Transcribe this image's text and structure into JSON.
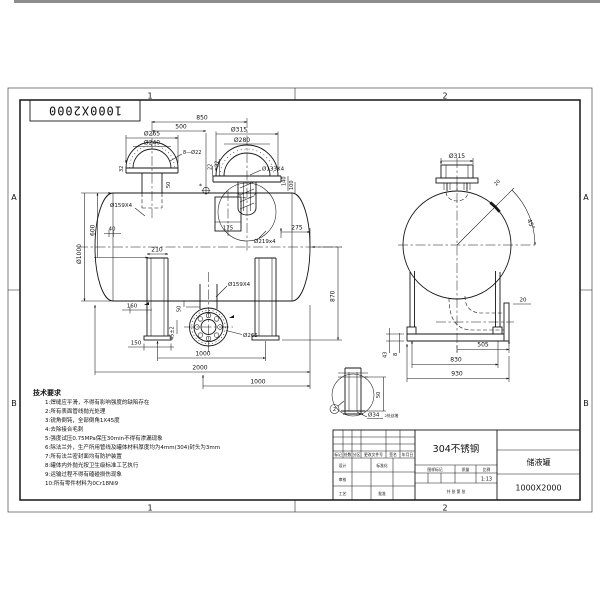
{
  "frame": {
    "corner_number": "1000X2000",
    "zones": {
      "t1": "1",
      "t2": "2",
      "b1": "1",
      "b2": "2",
      "la": "A",
      "lb": "B",
      "ra": "A",
      "rb": "B"
    }
  },
  "front": {
    "d850": "850",
    "d500": "500",
    "d265": "Ø265",
    "d240": "Ø240",
    "bolt8": "8—Ø22",
    "s32l": "32",
    "s50": "50",
    "d315": "Ø315",
    "d280": "Ø280",
    "s22": "22",
    "s32r": "32",
    "d133": "Ø133X4",
    "d219": "Ø219x4",
    "d140": "140",
    "d100": "100",
    "star": "*",
    "d175": "175",
    "dia1000": "Ø1000",
    "d600": "600",
    "d40": "40",
    "d159t": "Ø159X4",
    "d210": "210",
    "d160": "160",
    "d150": "150",
    "d50": "50",
    "d45": "45±2",
    "d159b": "Ø159X4",
    "d265b": "Ø265",
    "d1000l": "1000",
    "d2000": "2000",
    "d1000r": "1000",
    "d275": "275",
    "d870": "870"
  },
  "end": {
    "d315": "Ø315",
    "a45": "45°",
    "d20pad": "20",
    "d20plate": "20",
    "d505": "505",
    "d830": "830",
    "d930": "930",
    "d43": "43",
    "d8": "8"
  },
  "detail": {
    "d50": "50",
    "d34": "Ø34",
    "note": "2处丝堵",
    "balloon": "2"
  },
  "tech": {
    "title": "技术要求",
    "items": [
      "1:焊缝应平滑，不得有影响强度的缺陷存在",
      "2:所有表面管线抛光处理",
      "3:锐角倒钝，全部倒角1X45度",
      "4:去除接合毛刺",
      "5:强度试压0.75MPa保压30min不得有渗漏现象",
      "6:除法兰外，生产所用管线及罐体材料厚度均为4mm(304)封头为3mm",
      "7:所有法兰密封面均有防护装置",
      "8:罐体内外抛光按卫生级标准工艺执行",
      "9:运输过程不得有磕碰损伤现象",
      "10:所有零件材料为0Cr18Ni9"
    ]
  },
  "tb": {
    "material": "304不锈钢",
    "name": "储液罐",
    "number": "1000X2000",
    "scale": "1:13",
    "rev_headers": [
      "标记",
      "处数",
      "分区",
      "更改文件号",
      "签名",
      "年月日"
    ],
    "r_design": "设计",
    "r_std": "标准化",
    "r_check": "审核",
    "r_proc": "工艺",
    "r_appr": "批准",
    "h_mark": "图样标记",
    "h_weight": "质量",
    "h_scale": "比例",
    "sheets": "共 张 第 张"
  }
}
